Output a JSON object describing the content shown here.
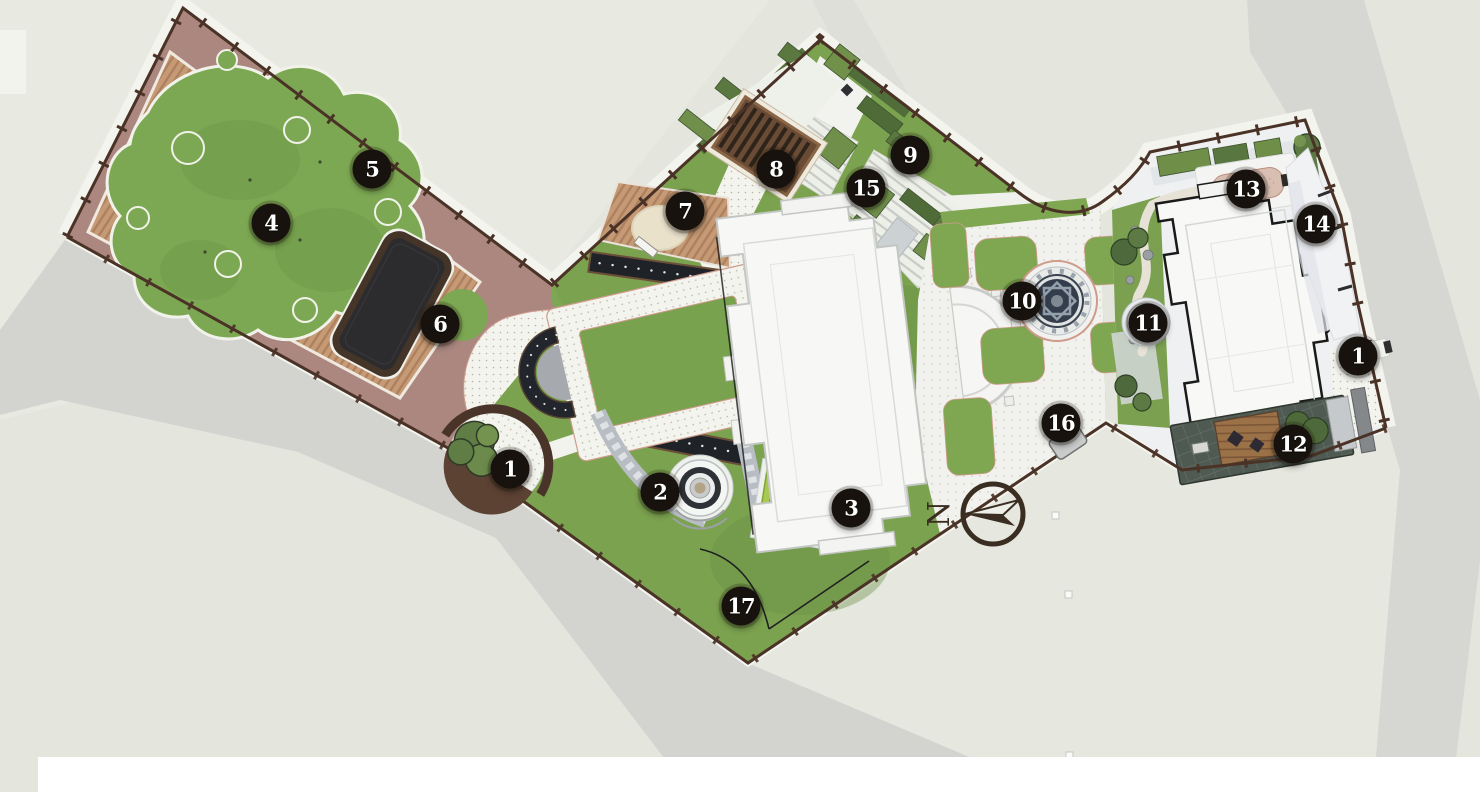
{
  "plan": {
    "type": "landscape master plan site drawing (top view)",
    "compass": {
      "label": "N"
    },
    "markers": [
      {
        "label": "4",
        "x": 271,
        "y": 223
      },
      {
        "label": "5",
        "x": 372,
        "y": 169
      },
      {
        "label": "6",
        "x": 440,
        "y": 324
      },
      {
        "label": "1",
        "x": 510,
        "y": 469
      },
      {
        "label": "2",
        "x": 660,
        "y": 492
      },
      {
        "label": "3",
        "x": 851,
        "y": 508
      },
      {
        "label": "17",
        "x": 741,
        "y": 606
      },
      {
        "label": "7",
        "x": 685,
        "y": 211
      },
      {
        "label": "8",
        "x": 776,
        "y": 169
      },
      {
        "label": "9",
        "x": 910,
        "y": 155
      },
      {
        "label": "15",
        "x": 866,
        "y": 188
      },
      {
        "label": "10",
        "x": 1022,
        "y": 301
      },
      {
        "label": "11",
        "x": 1148,
        "y": 323
      },
      {
        "label": "16",
        "x": 1061,
        "y": 423
      },
      {
        "label": "13",
        "x": 1246,
        "y": 189
      },
      {
        "label": "14",
        "x": 1316,
        "y": 224
      },
      {
        "label": "1",
        "x": 1358,
        "y": 356
      },
      {
        "label": "12",
        "x": 1293,
        "y": 444
      }
    ],
    "palette": {
      "background": "#e4e6dd",
      "road_gray": "#d3d4d0",
      "lawn": "#7ba24f",
      "lawn_dark": "#5a7840",
      "deck_wood": "#c59a74",
      "paving_mauve": "#ab8780",
      "path_white": "#f3f4ee",
      "water_dark": "#2c2c2e",
      "fence_brown": "#4a3226",
      "building_white": "#f7f8f6",
      "accent_pink": "#cf9b8b",
      "marker_bg": "#17120d",
      "marker_text": "#ffffff"
    }
  }
}
